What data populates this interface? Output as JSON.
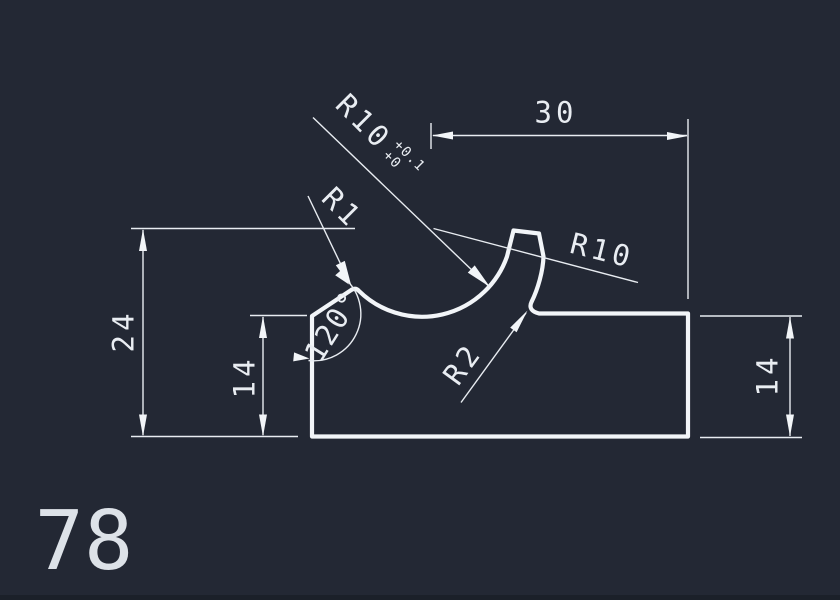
{
  "app": {
    "type": "cad-drawing-view",
    "background": "#232834",
    "line_color": "#eef1f5",
    "text_color": "#e9edf2",
    "bottom_bar_color": "#1b2029"
  },
  "drawing": {
    "part_number": "78",
    "labels": {
      "width_top": "30",
      "height_overall": "24",
      "height_left": "14",
      "height_right": "14",
      "angle": "120°",
      "radius_groove_main": "R10",
      "radius_groove_tol_upper": "+0.1",
      "radius_groove_tol_lower": "+0",
      "radius_tip": "R1",
      "radius_outer": "R10",
      "radius_fillet": "R2"
    }
  }
}
